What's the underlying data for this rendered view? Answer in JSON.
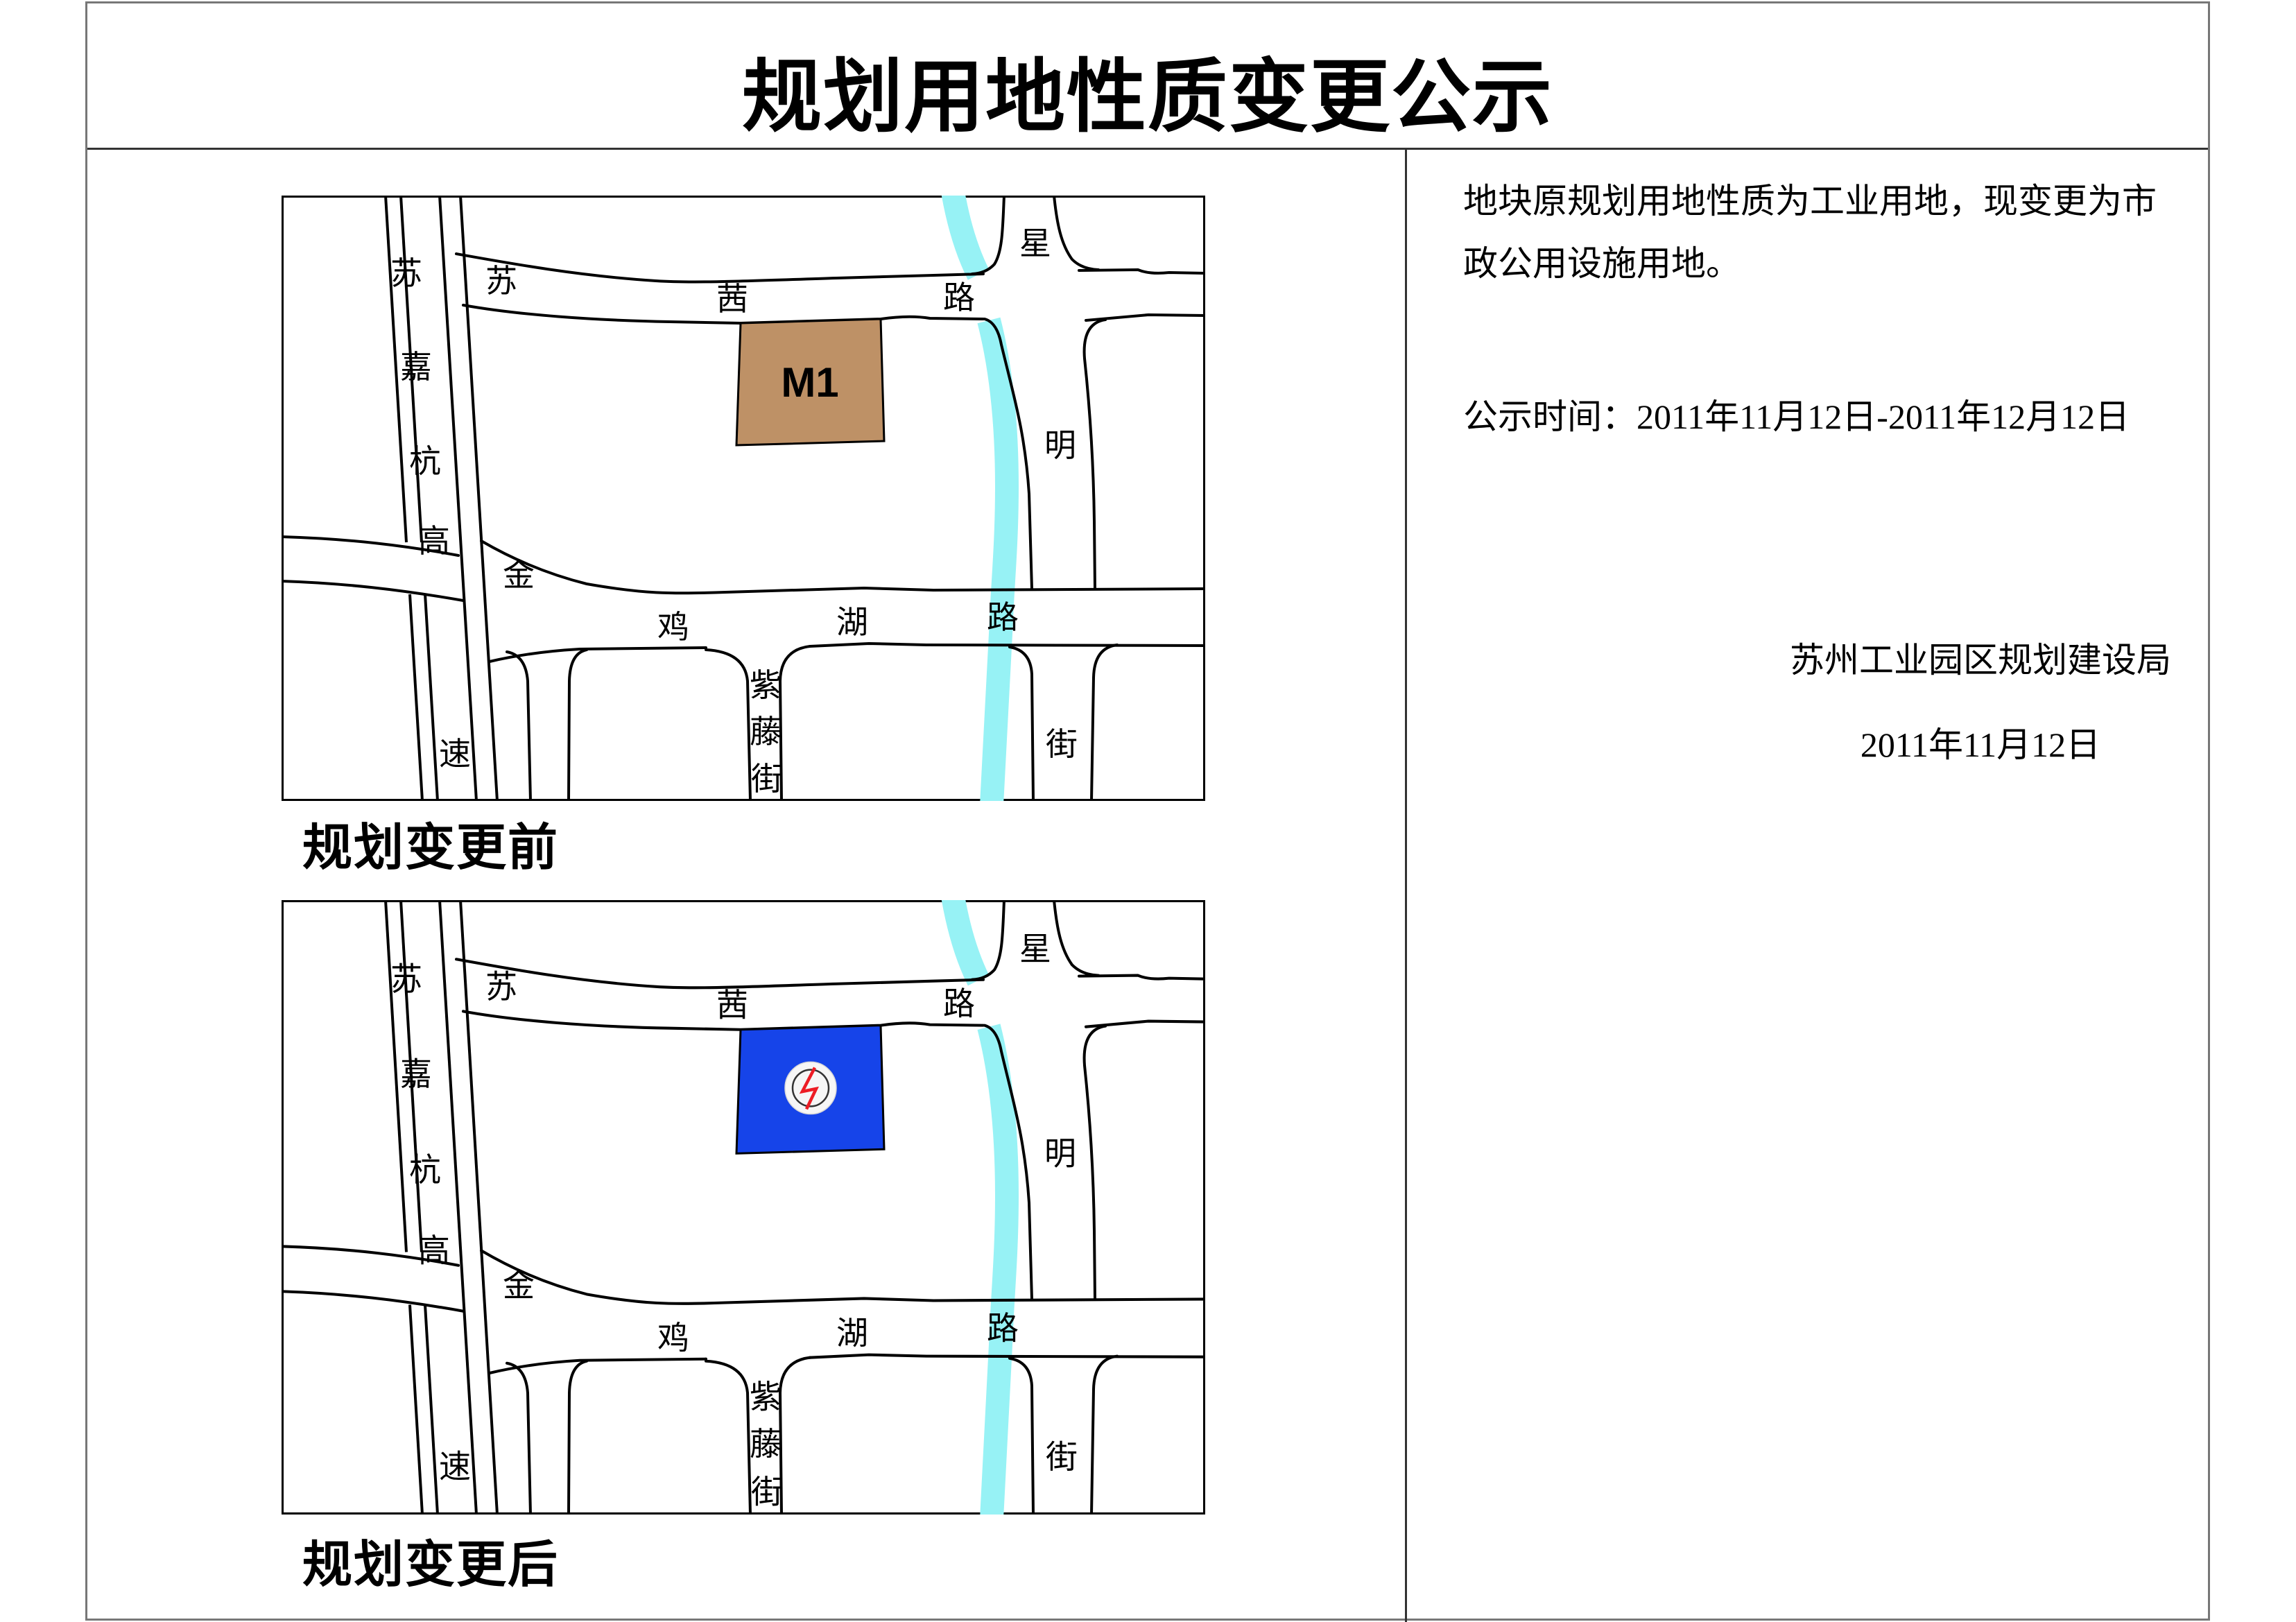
{
  "title": "规划用地性质变更公示",
  "maps": {
    "before": {
      "caption": "规划变更前",
      "parcel_label": "M1",
      "parcel_color": "#BE9166"
    },
    "after": {
      "caption": "规划变更后",
      "parcel_color": "#1644E9",
      "symbol": "power-substation"
    },
    "river_color": "#97F2F5",
    "roads": {
      "expressway": [
        "苏",
        "嘉",
        "杭",
        "高",
        "速"
      ],
      "suqian": [
        "苏",
        "茜",
        "路"
      ],
      "jinjihu": [
        "金",
        "鸡",
        "湖",
        "路"
      ],
      "xingming": [
        "星",
        "明",
        "街"
      ],
      "ziteng": [
        "紫",
        "藤",
        "街"
      ]
    }
  },
  "notice": {
    "para_line1": "地块原规划用地性质为工业用地，现变更为市",
    "para_line2": "政公用设施用地。",
    "period_line": "公示时间：2011年11月12日-2011年12月12日",
    "authority": "苏州工业园区规划建设局",
    "date": "2011年11月12日"
  }
}
